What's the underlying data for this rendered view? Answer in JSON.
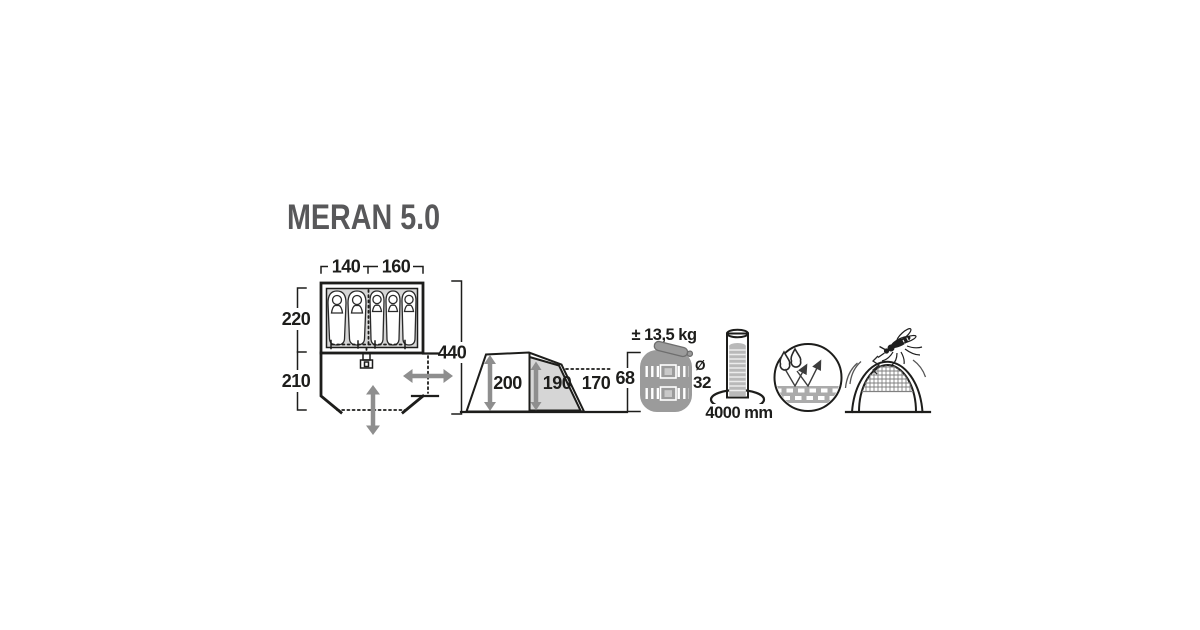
{
  "title": "MERAN 5.0",
  "colors": {
    "line": "#1d1d1b",
    "title_text": "#58585a",
    "panel_gray": "#d6d6d6",
    "arrow_gray": "#8e8e8e",
    "bag_gray": "#9b9b9b",
    "water_gray": "#b9b9b9"
  },
  "floorplan": {
    "width_left_label": "140",
    "width_right_label": "160",
    "depth_sleeping_label": "220",
    "depth_porch_label": "210",
    "length_total_label": "440",
    "sleeper_count": 5
  },
  "sideview": {
    "height_front_label": "200",
    "height_cabin_label": "190",
    "height_rear_label": "170"
  },
  "pack_size": {
    "weight_label": "± 13,5 kg",
    "length_label": "68",
    "diameter_symbol": "Ø",
    "diameter_label": "32"
  },
  "water_column": {
    "value_label": "4000 mm"
  }
}
